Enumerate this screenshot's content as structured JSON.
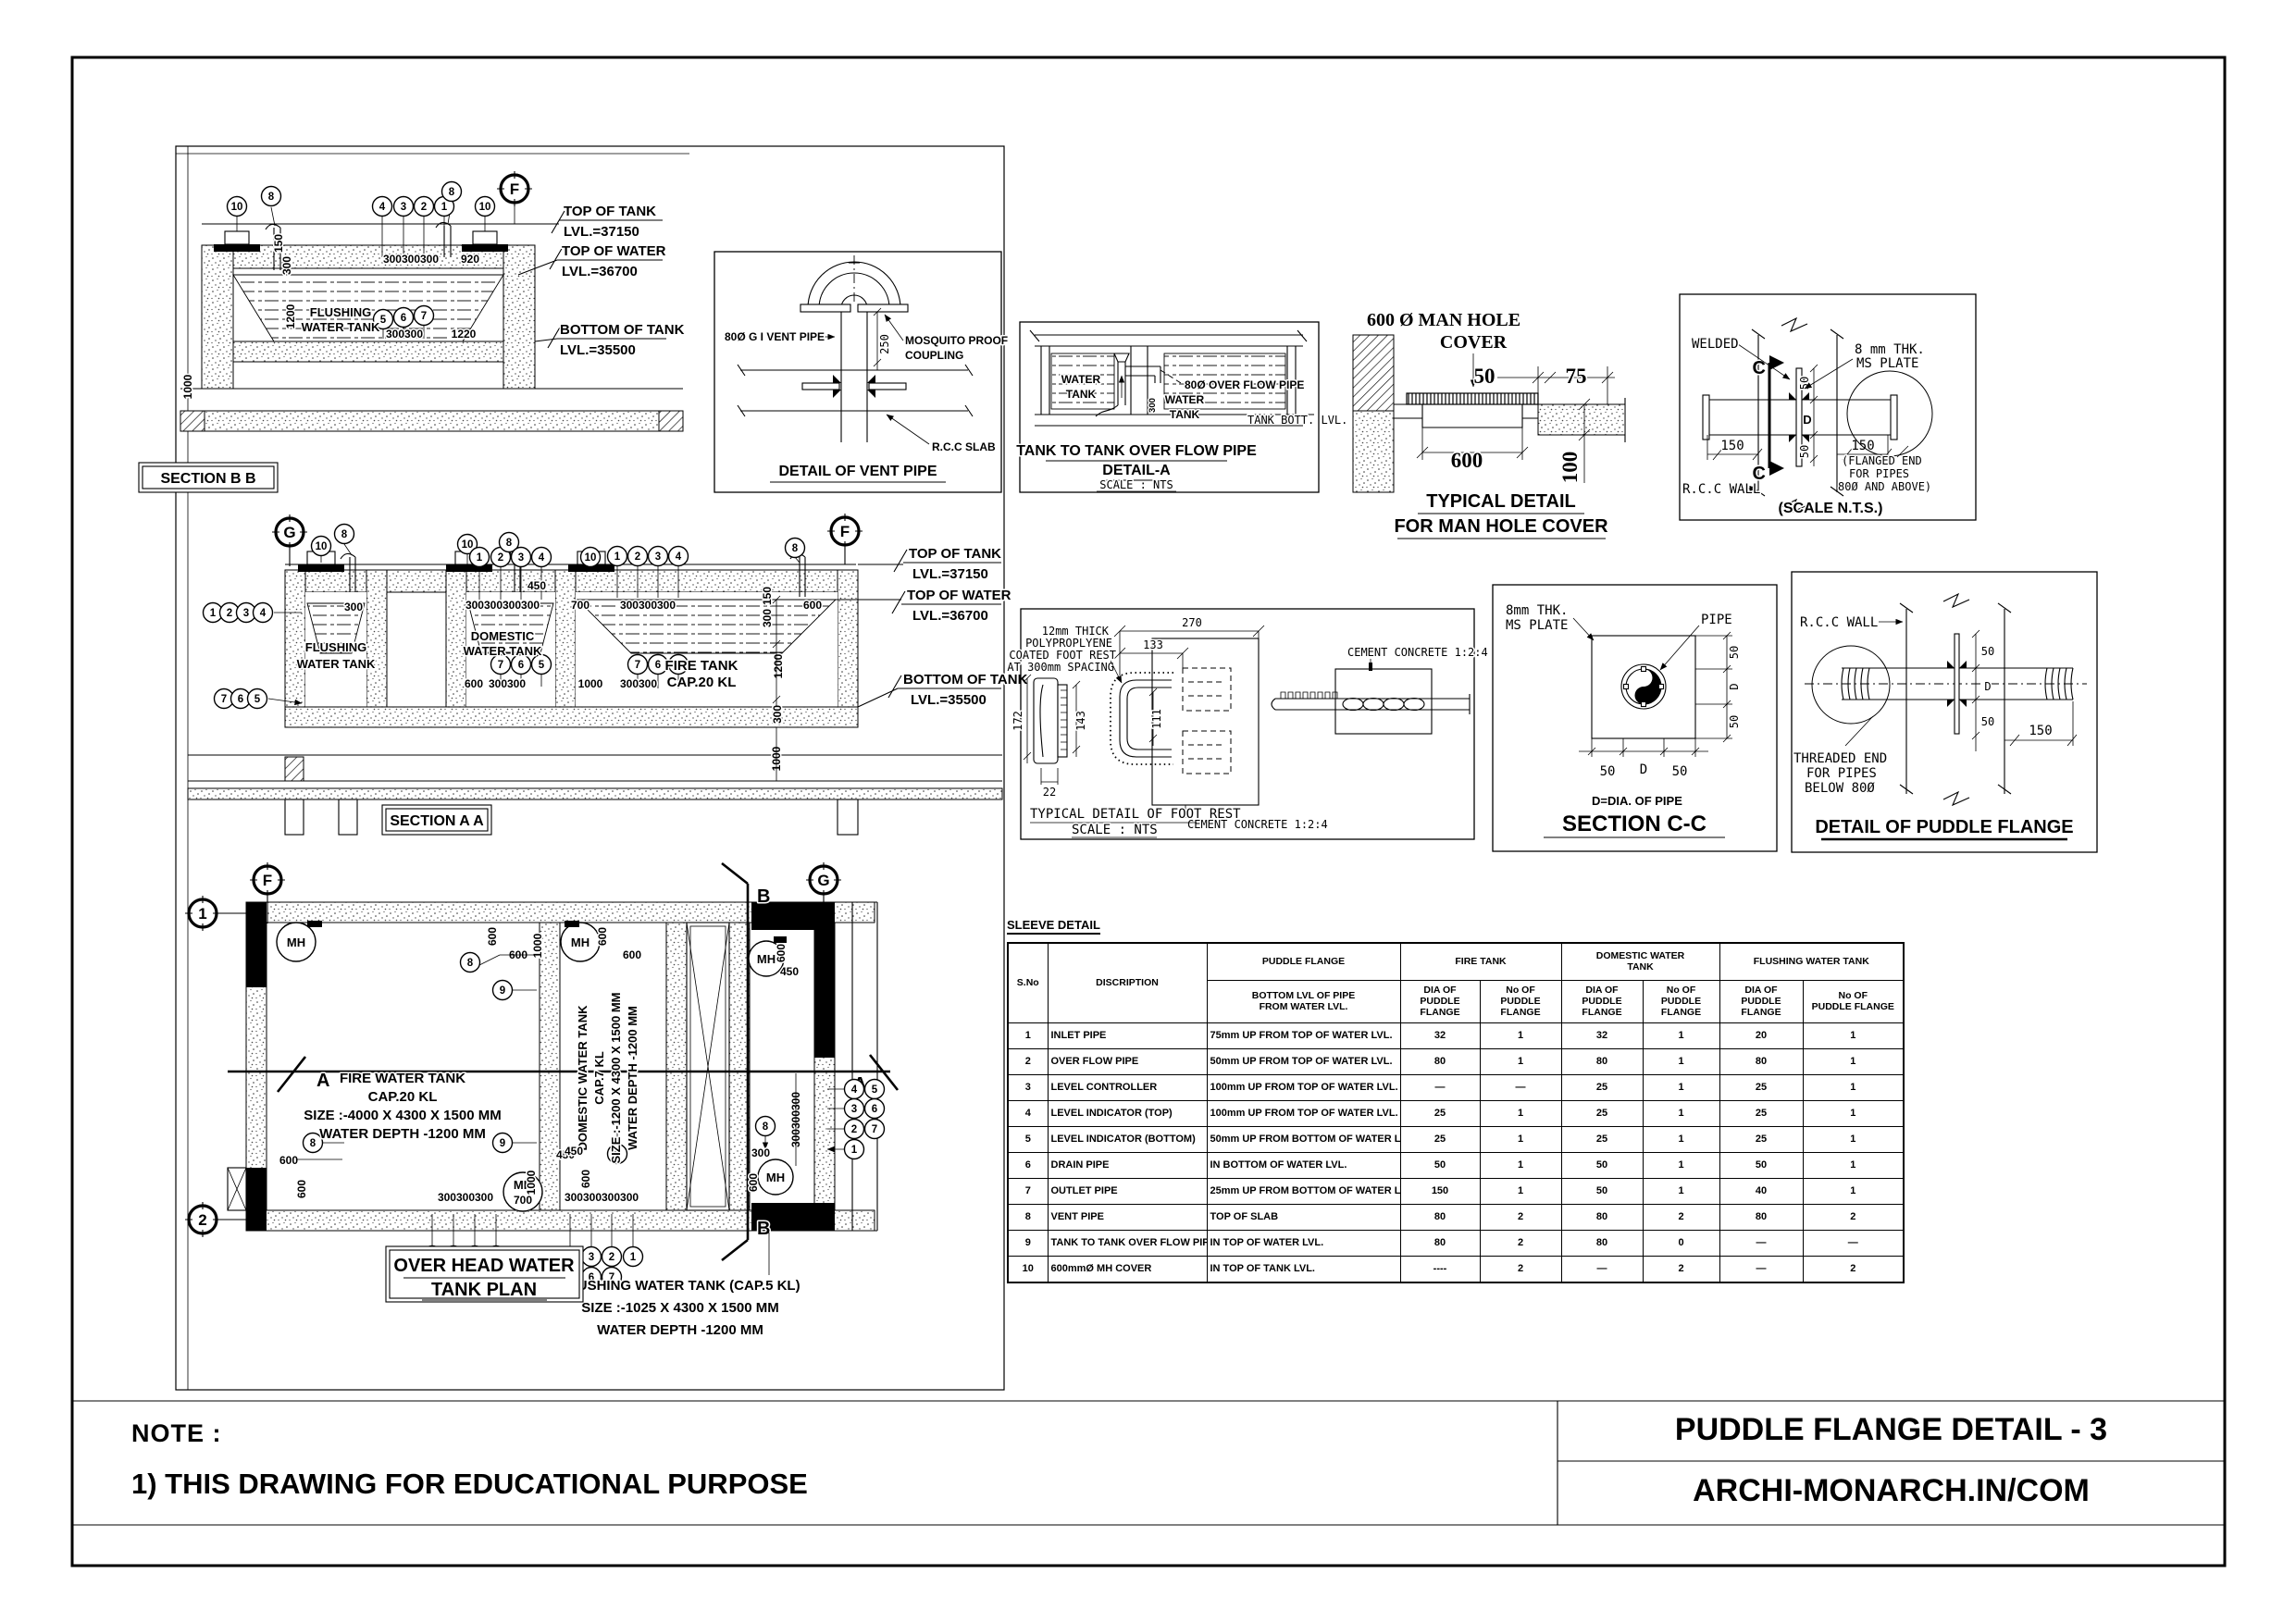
{
  "sheet": {
    "note_heading": "NOTE :",
    "note_line": "1) THIS DRAWING FOR EDUCATIONAL PURPOSE",
    "title": "PUDDLE FLANGE DETAIL - 3",
    "website": "ARCHI-MONARCH.IN/COM"
  },
  "levels": {
    "top_tank": "TOP OF TANK",
    "top_tank_lvl": "LVL.=37150",
    "top_water": "TOP OF WATER",
    "top_water_lvl": "LVL.=36700",
    "bottom_tank": "BOTTOM OF TANK",
    "bottom_tank_lvl": "LVL.=35500"
  },
  "section_bb": {
    "title": "SECTION B B",
    "tank": [
      "FLUSHING",
      "WATER TANK"
    ],
    "grid": "F",
    "callouts_top": [
      "10",
      "8",
      "4",
      "3",
      "2",
      "1",
      "8",
      "10"
    ],
    "callouts_mid": [
      "5",
      "6",
      "7"
    ],
    "dims": [
      "920",
      "300300300",
      "1220",
      "300300",
      "150",
      "300",
      "1200",
      "1000"
    ]
  },
  "vent_detail": {
    "title": "DETAIL OF VENT PIPE",
    "pipe_label": "80Ø G I VENT PIPE",
    "coupling": [
      "MOSQUITO PROOF",
      "COUPLING"
    ],
    "slab": "R.C.C SLAB",
    "dim250": "250"
  },
  "overflow_detail": {
    "title1": "TANK TO TANK OVER FLOW PIPE",
    "title2": "DETAIL-A",
    "scale": "SCALE : NTS",
    "left_tank": [
      "WATER",
      "TANK"
    ],
    "right_tank": [
      "WATER",
      "TANK"
    ],
    "pipe_label": "80Ø OVER FLOW PIPE",
    "bott": "TANK BOTT. LVL.",
    "dim300": "300"
  },
  "manhole_detail": {
    "head": [
      "600 Ø MAN HOLE",
      "COVER"
    ],
    "title1": "TYPICAL DETAIL",
    "title2": "FOR MAN HOLE COVER",
    "d50": "50",
    "d75": "75",
    "d600": "600",
    "d100": "100"
  },
  "flange_weld_detail": {
    "welded": "WELDED",
    "plate": [
      "8 mm THK.",
      "MS PLATE"
    ],
    "c": "C",
    "d": "D",
    "d50a": "50",
    "d50b": "50",
    "d150a": "150",
    "d150b": "150",
    "flanged": [
      "(FLANGED END",
      "FOR PIPES",
      "80Ø AND ABOVE)"
    ],
    "wall": "R.C.C WALL",
    "scale": "(SCALE N.T.S.)"
  },
  "section_aa": {
    "title": "SECTION A A",
    "grid": [
      "G",
      "F"
    ],
    "flushing": [
      "FLUSHING",
      "WATER TANK"
    ],
    "domestic": [
      "DOMESTIC",
      "WATER TANK"
    ],
    "fire": [
      "FIRE TANK",
      "CAP.20 KL"
    ],
    "callouts_top": [
      "10",
      "8",
      "10",
      "1",
      "2",
      "8",
      "3",
      "4",
      "10",
      "1",
      "2",
      "3",
      "4",
      "8"
    ],
    "callouts_left": [
      "1",
      "2",
      "3",
      "4",
      "7",
      "6",
      "5"
    ],
    "callouts_dom": [
      "7",
      "6",
      "5"
    ],
    "callouts_fire": [
      "7",
      "6",
      "5"
    ],
    "dims": [
      "300",
      "450",
      "300300300300",
      "700",
      "300300300",
      "600",
      "600",
      "300300",
      "1000",
      "300300",
      "150",
      "300",
      "1200",
      "300",
      "1000"
    ]
  },
  "footrest_detail": {
    "title1": "TYPICAL DETAIL OF FOOT REST",
    "title2": "SCALE : NTS",
    "note": [
      "12mm THICK",
      "POLYPROPLYENE",
      "COATED FOOT REST",
      "AT 300mm SPACING"
    ],
    "cement_top": "CEMENT CONCRETE 1:2:4",
    "cement_bottom": "CEMENT CONCRETE 1:2:4",
    "d270": "270",
    "d133": "133",
    "d172": "172",
    "d143": "143",
    "d22": "22",
    "d111": "111"
  },
  "section_cc": {
    "title": "SECTION C-C",
    "plate": [
      "8mm THK.",
      "MS PLATE"
    ],
    "pipe": "PIPE",
    "dnote": "D=DIA. OF PIPE",
    "right_dims": [
      "50",
      "D",
      "50"
    ],
    "bottom_dims": [
      "50",
      "D",
      "50"
    ]
  },
  "puddle_flange_detail": {
    "title": "DETAIL OF PUDDLE FLANGE",
    "wall": "R.C.C WALL",
    "threaded": [
      "THREADED END",
      "FOR PIPES",
      "BELOW 80Ø"
    ],
    "d50a": "50",
    "dd": "D",
    "d50b": "50",
    "d150": "150"
  },
  "plan": {
    "title": [
      "OVER HEAD WATER",
      "TANK  PLAN"
    ],
    "grids": [
      "F",
      "G",
      "1",
      "2"
    ],
    "sec_a": "A",
    "sec_b": "B",
    "mh": "MH",
    "mh_700": "700",
    "fire_label": [
      "FIRE WATER TANK",
      "CAP.20 KL",
      "SIZE :-4000 X  4300 X 1500 MM",
      "WATER DEPTH -1200 MM"
    ],
    "domestic_label": [
      "DOMESTIC WATER TANK",
      "CAP.7 KL",
      "SIZE :-1200 X 4300 X 1500 MM",
      "WATER DEPTH -1200 MM"
    ],
    "flushing_label": [
      "FLUSHING WATER TANK (CAP.5 KL)",
      "SIZE :-1025 X  4300 X 1500 MM",
      "WATER DEPTH -1200 MM"
    ],
    "callouts": [
      "8",
      "9",
      "8",
      "9",
      "8",
      "8"
    ],
    "cluster1": [
      "4",
      "3",
      "2",
      "1",
      "5",
      "6",
      "7"
    ],
    "cluster2": [
      "4",
      "3",
      "2",
      "1",
      "5",
      "6",
      "7"
    ],
    "cluster_right": [
      "4",
      "5",
      "3",
      "6",
      "2",
      "7",
      "1"
    ],
    "dims": [
      "600",
      "600",
      "1000",
      "600",
      "600",
      "450",
      "1000",
      "300300300",
      "600",
      "600",
      "450",
      "600",
      "300",
      "600",
      "300300300300",
      "450",
      "300300300",
      "600"
    ]
  },
  "sleeve_table": {
    "caption": "SLEEVE DETAIL",
    "corner": [
      "S.No",
      "DISCRIPTION"
    ],
    "group_headers": [
      "PUDDLE FLANGE",
      "FIRE TANK",
      "DOMESTIC WATER\nTANK",
      "FLUSHING WATER TANK"
    ],
    "sub_headers": [
      "BOTTOM LVL OF PIPE\nFROM WATER LVL.",
      "DIA OF\nPUDDLE FLANGE",
      "No OF\nPUDDLE FLANGE",
      "DIA OF\nPUDDLE FLANGE",
      "No OF\nPUDDLE FLANGE",
      "DIA OF\nPUDDLE FLANGE",
      "No OF\nPUDDLE FLANGE"
    ],
    "rows": [
      [
        "1",
        "INLET PIPE",
        "75mm UP FROM TOP OF WATER LVL.",
        "32",
        "1",
        "32",
        "1",
        "20",
        "1"
      ],
      [
        "2",
        "OVER FLOW PIPE",
        "50mm UP FROM TOP OF WATER LVL.",
        "80",
        "1",
        "80",
        "1",
        "80",
        "1"
      ],
      [
        "3",
        "LEVEL CONTROLLER",
        "100mm UP FROM TOP OF WATER LVL.",
        "—",
        "—",
        "25",
        "1",
        "25",
        "1"
      ],
      [
        "4",
        "LEVEL INDICATOR (TOP)",
        "100mm UP FROM TOP OF WATER LVL.",
        "25",
        "1",
        "25",
        "1",
        "25",
        "1"
      ],
      [
        "5",
        "LEVEL INDICATOR (BOTTOM)",
        "50mm UP FROM BOTTOM OF WATER LVL.",
        "25",
        "1",
        "25",
        "1",
        "25",
        "1"
      ],
      [
        "6",
        "DRAIN PIPE",
        "IN BOTTOM OF WATER LVL.",
        "50",
        "1",
        "50",
        "1",
        "50",
        "1"
      ],
      [
        "7",
        "OUTLET PIPE",
        "25mm UP FROM BOTTOM OF WATER LVL.",
        "150",
        "1",
        "50",
        "1",
        "40",
        "1"
      ],
      [
        "8",
        "VENT PIPE",
        "TOP OF SLAB",
        "80",
        "2",
        "80",
        "2",
        "80",
        "2"
      ],
      [
        "9",
        "TANK TO TANK OVER FLOW PIPE",
        "IN TOP OF WATER LVL.",
        "80",
        "2",
        "80",
        "0",
        "—",
        "—"
      ],
      [
        "10",
        "600mmØ MH COVER",
        "IN TOP OF TANK LVL.",
        "----",
        "2",
        "—",
        "2",
        "—",
        "2"
      ]
    ]
  }
}
